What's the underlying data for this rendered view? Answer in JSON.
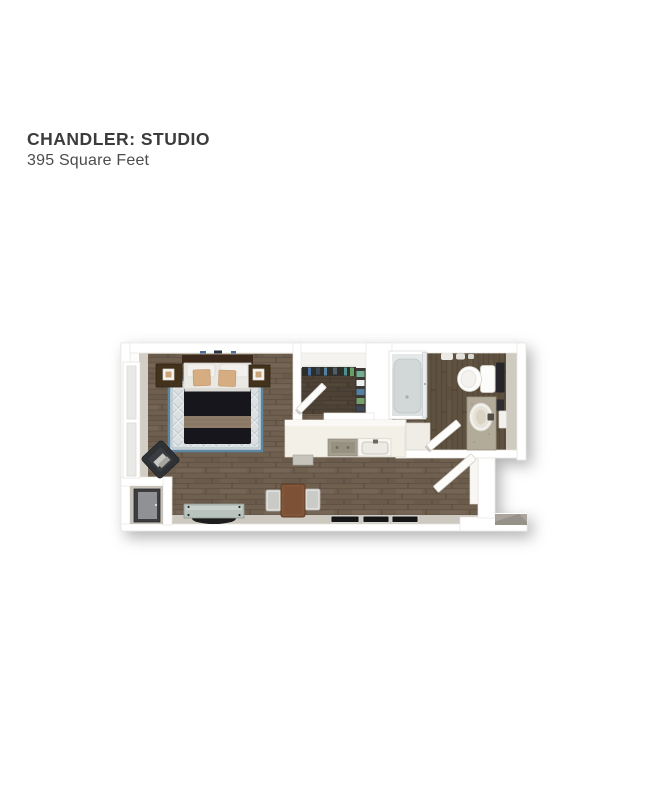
{
  "page": {
    "width": 657,
    "height": 791,
    "background": "#ffffff"
  },
  "header": {
    "title": "CHANDLER: STUDIO",
    "subtitle": "395 Square Feet"
  },
  "floor_plan": {
    "alt": "3D overhead rendering of the Chandler studio apartment floor plan",
    "rooms": [
      "living and sleeping area",
      "walk-in closet",
      "kitchen",
      "bathroom",
      "entry",
      "utility closet"
    ],
    "furnishings": [
      "bed with two nightstands",
      "diamond-pattern area rug",
      "lounge chair",
      "media console",
      "dining table with two chairs",
      "kitchen counter with cooktop and sink",
      "dishwasher",
      "shower with glass door",
      "toilet",
      "vanity sink",
      "entry landing",
      "three floor mats"
    ],
    "palette": {
      "wood_floor": "#6e5f50",
      "closet_floor": "#4e4236",
      "bathroom_floor": "#5f5140",
      "walls": "#ffffff",
      "wall_face": "#cdc9c0",
      "rug_field": "#dbdfe0",
      "rug_border": "#5d86a3",
      "bedding_dark": "#17181c",
      "accent_pillow": "#d6ac81",
      "counter": "#f3f0e8",
      "granite": "#a49e8f",
      "vanity": "#b2ab9a",
      "landing": "#a9a59d"
    }
  }
}
